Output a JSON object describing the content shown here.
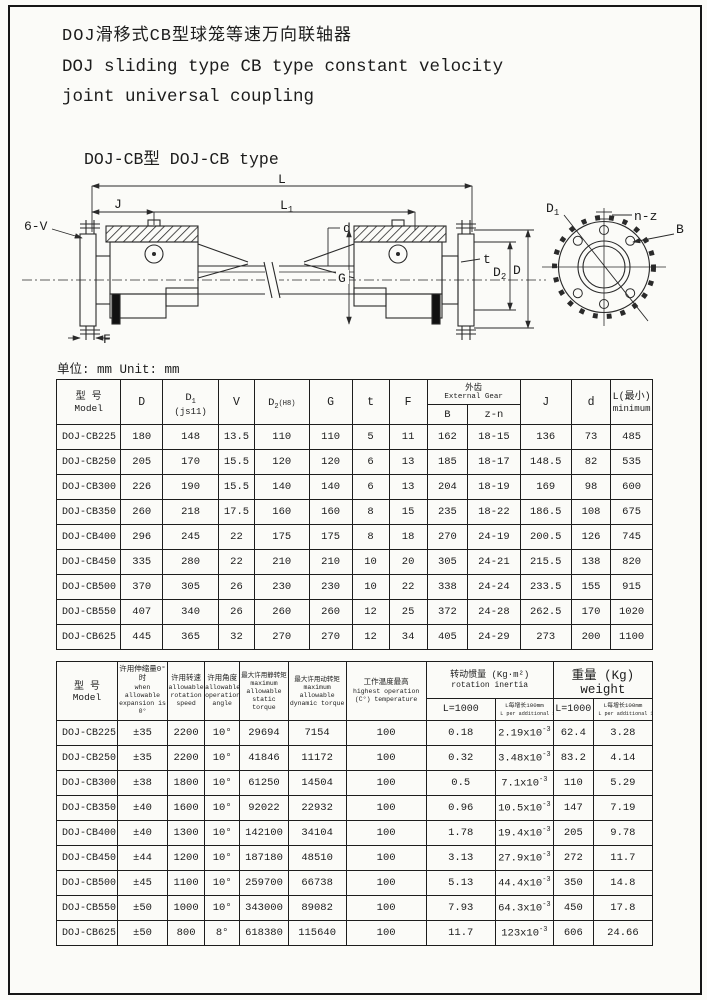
{
  "header": {
    "title_zh": "DOJ滑移式CB型球笼等速万向联轴器",
    "title_en_1": "DOJ sliding type CB type constant velocity",
    "title_en_2": "joint universal coupling",
    "subtitle": "DOJ-CB型 DOJ-CB type",
    "unit_label": "单位: mm Unit: mm"
  },
  "drawing": {
    "labels": {
      "L": "L",
      "J": "J",
      "L1": {
        "main": "L",
        "sub": "1"
      },
      "bolt_spec": "6-V",
      "shaft_dia": "d",
      "G": "G",
      "t": "t",
      "D2": {
        "main": "D",
        "sub": "2"
      },
      "D": "D",
      "F": "F",
      "D1": {
        "main": "D",
        "sub": "1"
      },
      "holes": "n-z",
      "B": "B"
    }
  },
  "table1": {
    "headers": {
      "model_zh": "型 号",
      "model_en": "Model",
      "D": "D",
      "D1_main": "D",
      "D1_sub": "1",
      "D1_note": "(js11)",
      "V": "V",
      "D2_main": "D",
      "D2_sub": "2",
      "D2_note": "(H8)",
      "G": "G",
      "t": "t",
      "F": "F",
      "ext_gear_zh": "外齿",
      "ext_gear_en": "External Gear",
      "B": "B",
      "zn": "z-n",
      "J": "J",
      "d": "d",
      "L_zh": "L(最小)",
      "L_en": "minimum"
    },
    "rows": [
      {
        "model": "DOJ-CB225",
        "D": "180",
        "D1": "148",
        "V": "13.5",
        "D2": "110",
        "G": "110",
        "t": "5",
        "F": "11",
        "B": "162",
        "zn": "18-15",
        "J": "136",
        "d": "73",
        "L": "485"
      },
      {
        "model": "DOJ-CB250",
        "D": "205",
        "D1": "170",
        "V": "15.5",
        "D2": "120",
        "G": "120",
        "t": "6",
        "F": "13",
        "B": "185",
        "zn": "18-17",
        "J": "148.5",
        "d": "82",
        "L": "535"
      },
      {
        "model": "DOJ-CB300",
        "D": "226",
        "D1": "190",
        "V": "15.5",
        "D2": "140",
        "G": "140",
        "t": "6",
        "F": "13",
        "B": "204",
        "zn": "18-19",
        "J": "169",
        "d": "98",
        "L": "600"
      },
      {
        "model": "DOJ-CB350",
        "D": "260",
        "D1": "218",
        "V": "17.5",
        "D2": "160",
        "G": "160",
        "t": "8",
        "F": "15",
        "B": "235",
        "zn": "18-22",
        "J": "186.5",
        "d": "108",
        "L": "675"
      },
      {
        "model": "DOJ-CB400",
        "D": "296",
        "D1": "245",
        "V": "22",
        "D2": "175",
        "G": "175",
        "t": "8",
        "F": "18",
        "B": "270",
        "zn": "24-19",
        "J": "200.5",
        "d": "126",
        "L": "745"
      },
      {
        "model": "DOJ-CB450",
        "D": "335",
        "D1": "280",
        "V": "22",
        "D2": "210",
        "G": "210",
        "t": "10",
        "F": "20",
        "B": "305",
        "zn": "24-21",
        "J": "215.5",
        "d": "138",
        "L": "820"
      },
      {
        "model": "DOJ-CB500",
        "D": "370",
        "D1": "305",
        "V": "26",
        "D2": "230",
        "G": "230",
        "t": "10",
        "F": "22",
        "B": "338",
        "zn": "24-24",
        "J": "233.5",
        "d": "155",
        "L": "915"
      },
      {
        "model": "DOJ-CB550",
        "D": "407",
        "D1": "340",
        "V": "26",
        "D2": "260",
        "G": "260",
        "t": "12",
        "F": "25",
        "B": "372",
        "zn": "24-28",
        "J": "262.5",
        "d": "170",
        "L": "1020"
      },
      {
        "model": "DOJ-CB625",
        "D": "445",
        "D1": "365",
        "V": "32",
        "D2": "270",
        "G": "270",
        "t": "12",
        "F": "34",
        "B": "405",
        "zn": "24-29",
        "J": "273",
        "d": "200",
        "L": "1100"
      }
    ]
  },
  "table2": {
    "headers": {
      "model_zh": "型 号",
      "model_en": "Model",
      "expansion_zh": "许用伸缩量0° 时",
      "expansion_en": "when allowable expansion is 0°",
      "speed_zh": "许用转速",
      "speed_en": "allowable rotation speed",
      "angle_zh": "许用角度",
      "angle_en": "allowable operation angle",
      "static_zh": "最大许用静转矩",
      "static_en": "maximum allowable static torque",
      "static_unit": "N·m",
      "dynamic_zh": "最大许用动转矩",
      "dynamic_en": "maximum allowable dynamic torque",
      "dynamic_unit": "N·m",
      "temp_zh": "工作温度最高",
      "temp_en": "highest operation (C°) temperature",
      "inertia_zh": "转动惯量 (Kg·m²)",
      "inertia_en": "rotation inertia",
      "weight": "重量 (Kg) weight",
      "l1000": "L=1000",
      "per100_zh": "L每增长100mm",
      "per100_en": "L per additional 100mm"
    },
    "rows": [
      {
        "model": "DOJ-CB225",
        "expansion": "±35",
        "speed": "2200",
        "angle": "10°",
        "static_torque": "29694",
        "dynamic_torque": "7154",
        "temp": "100",
        "inertia_l1000": "0.18",
        "inertia_per": {
          "base": "2.19x10",
          "exp": "-3"
        },
        "weight_l1000": "62.4",
        "weight_per": "3.28"
      },
      {
        "model": "DOJ-CB250",
        "expansion": "±35",
        "speed": "2200",
        "angle": "10°",
        "static_torque": "41846",
        "dynamic_torque": "11172",
        "temp": "100",
        "inertia_l1000": "0.32",
        "inertia_per": {
          "base": "3.48x10",
          "exp": "-3"
        },
        "weight_l1000": "83.2",
        "weight_per": "4.14"
      },
      {
        "model": "DOJ-CB300",
        "expansion": "±38",
        "speed": "1800",
        "angle": "10°",
        "static_torque": "61250",
        "dynamic_torque": "14504",
        "temp": "100",
        "inertia_l1000": "0.5",
        "inertia_per": {
          "base": "7.1x10",
          "exp": "-3"
        },
        "weight_l1000": "110",
        "weight_per": "5.29"
      },
      {
        "model": "DOJ-CB350",
        "expansion": "±40",
        "speed": "1600",
        "angle": "10°",
        "static_torque": "92022",
        "dynamic_torque": "22932",
        "temp": "100",
        "inertia_l1000": "0.96",
        "inertia_per": {
          "base": "10.5x10",
          "exp": "-3"
        },
        "weight_l1000": "147",
        "weight_per": "7.19"
      },
      {
        "model": "DOJ-CB400",
        "expansion": "±40",
        "speed": "1300",
        "angle": "10°",
        "static_torque": "142100",
        "dynamic_torque": "34104",
        "temp": "100",
        "inertia_l1000": "1.78",
        "inertia_per": {
          "base": "19.4x10",
          "exp": "-3"
        },
        "weight_l1000": "205",
        "weight_per": "9.78"
      },
      {
        "model": "DOJ-CB450",
        "expansion": "±44",
        "speed": "1200",
        "angle": "10°",
        "static_torque": "187180",
        "dynamic_torque": "48510",
        "temp": "100",
        "inertia_l1000": "3.13",
        "inertia_per": {
          "base": "27.9x10",
          "exp": "-3"
        },
        "weight_l1000": "272",
        "weight_per": "11.7"
      },
      {
        "model": "DOJ-CB500",
        "expansion": "±45",
        "speed": "1100",
        "angle": "10°",
        "static_torque": "259700",
        "dynamic_torque": "66738",
        "temp": "100",
        "inertia_l1000": "5.13",
        "inertia_per": {
          "base": "44.4x10",
          "exp": "-3"
        },
        "weight_l1000": "350",
        "weight_per": "14.8"
      },
      {
        "model": "DOJ-CB550",
        "expansion": "±50",
        "speed": "1000",
        "angle": "10°",
        "static_torque": "343000",
        "dynamic_torque": "89082",
        "temp": "100",
        "inertia_l1000": "7.93",
        "inertia_per": {
          "base": "64.3x10",
          "exp": "-3"
        },
        "weight_l1000": "450",
        "weight_per": "17.8"
      },
      {
        "model": "DOJ-CB625",
        "expansion": "±50",
        "speed": "800",
        "angle": "8°",
        "static_torque": "618380",
        "dynamic_torque": "115640",
        "temp": "100",
        "inertia_l1000": "11.7",
        "inertia_per": {
          "base": "123x10",
          "exp": "-3"
        },
        "weight_l1000": "606",
        "weight_per": "24.66"
      }
    ]
  }
}
